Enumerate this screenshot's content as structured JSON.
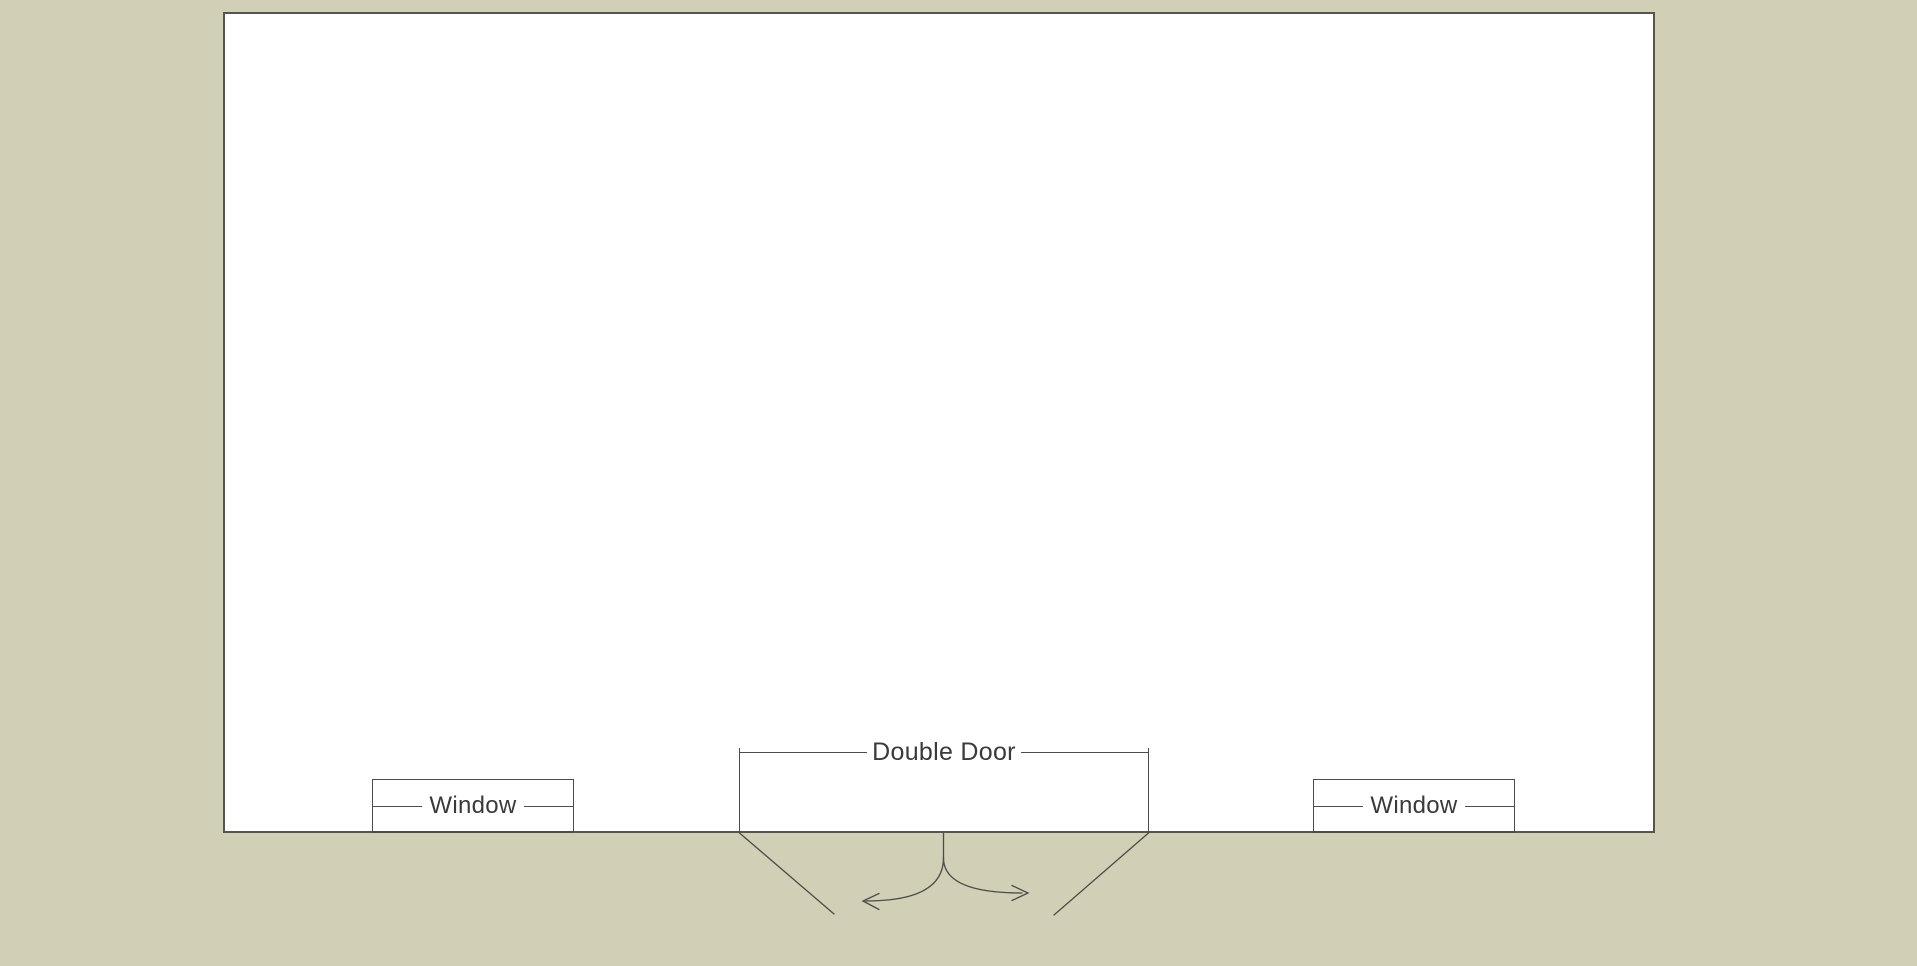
{
  "canvas": {
    "type": "floor-plan-drawing",
    "colors": {
      "canvas_background": "#d1cfb6",
      "room_fill": "#ffffff",
      "wall_stroke": "#55554f",
      "symbol_stroke": "#4c4c48",
      "label_text": "#3a3a3a"
    }
  },
  "symbols": {
    "double_door": {
      "label": "Double Door"
    },
    "window_left": {
      "label": "Window"
    },
    "window_right": {
      "label": "Window"
    }
  }
}
